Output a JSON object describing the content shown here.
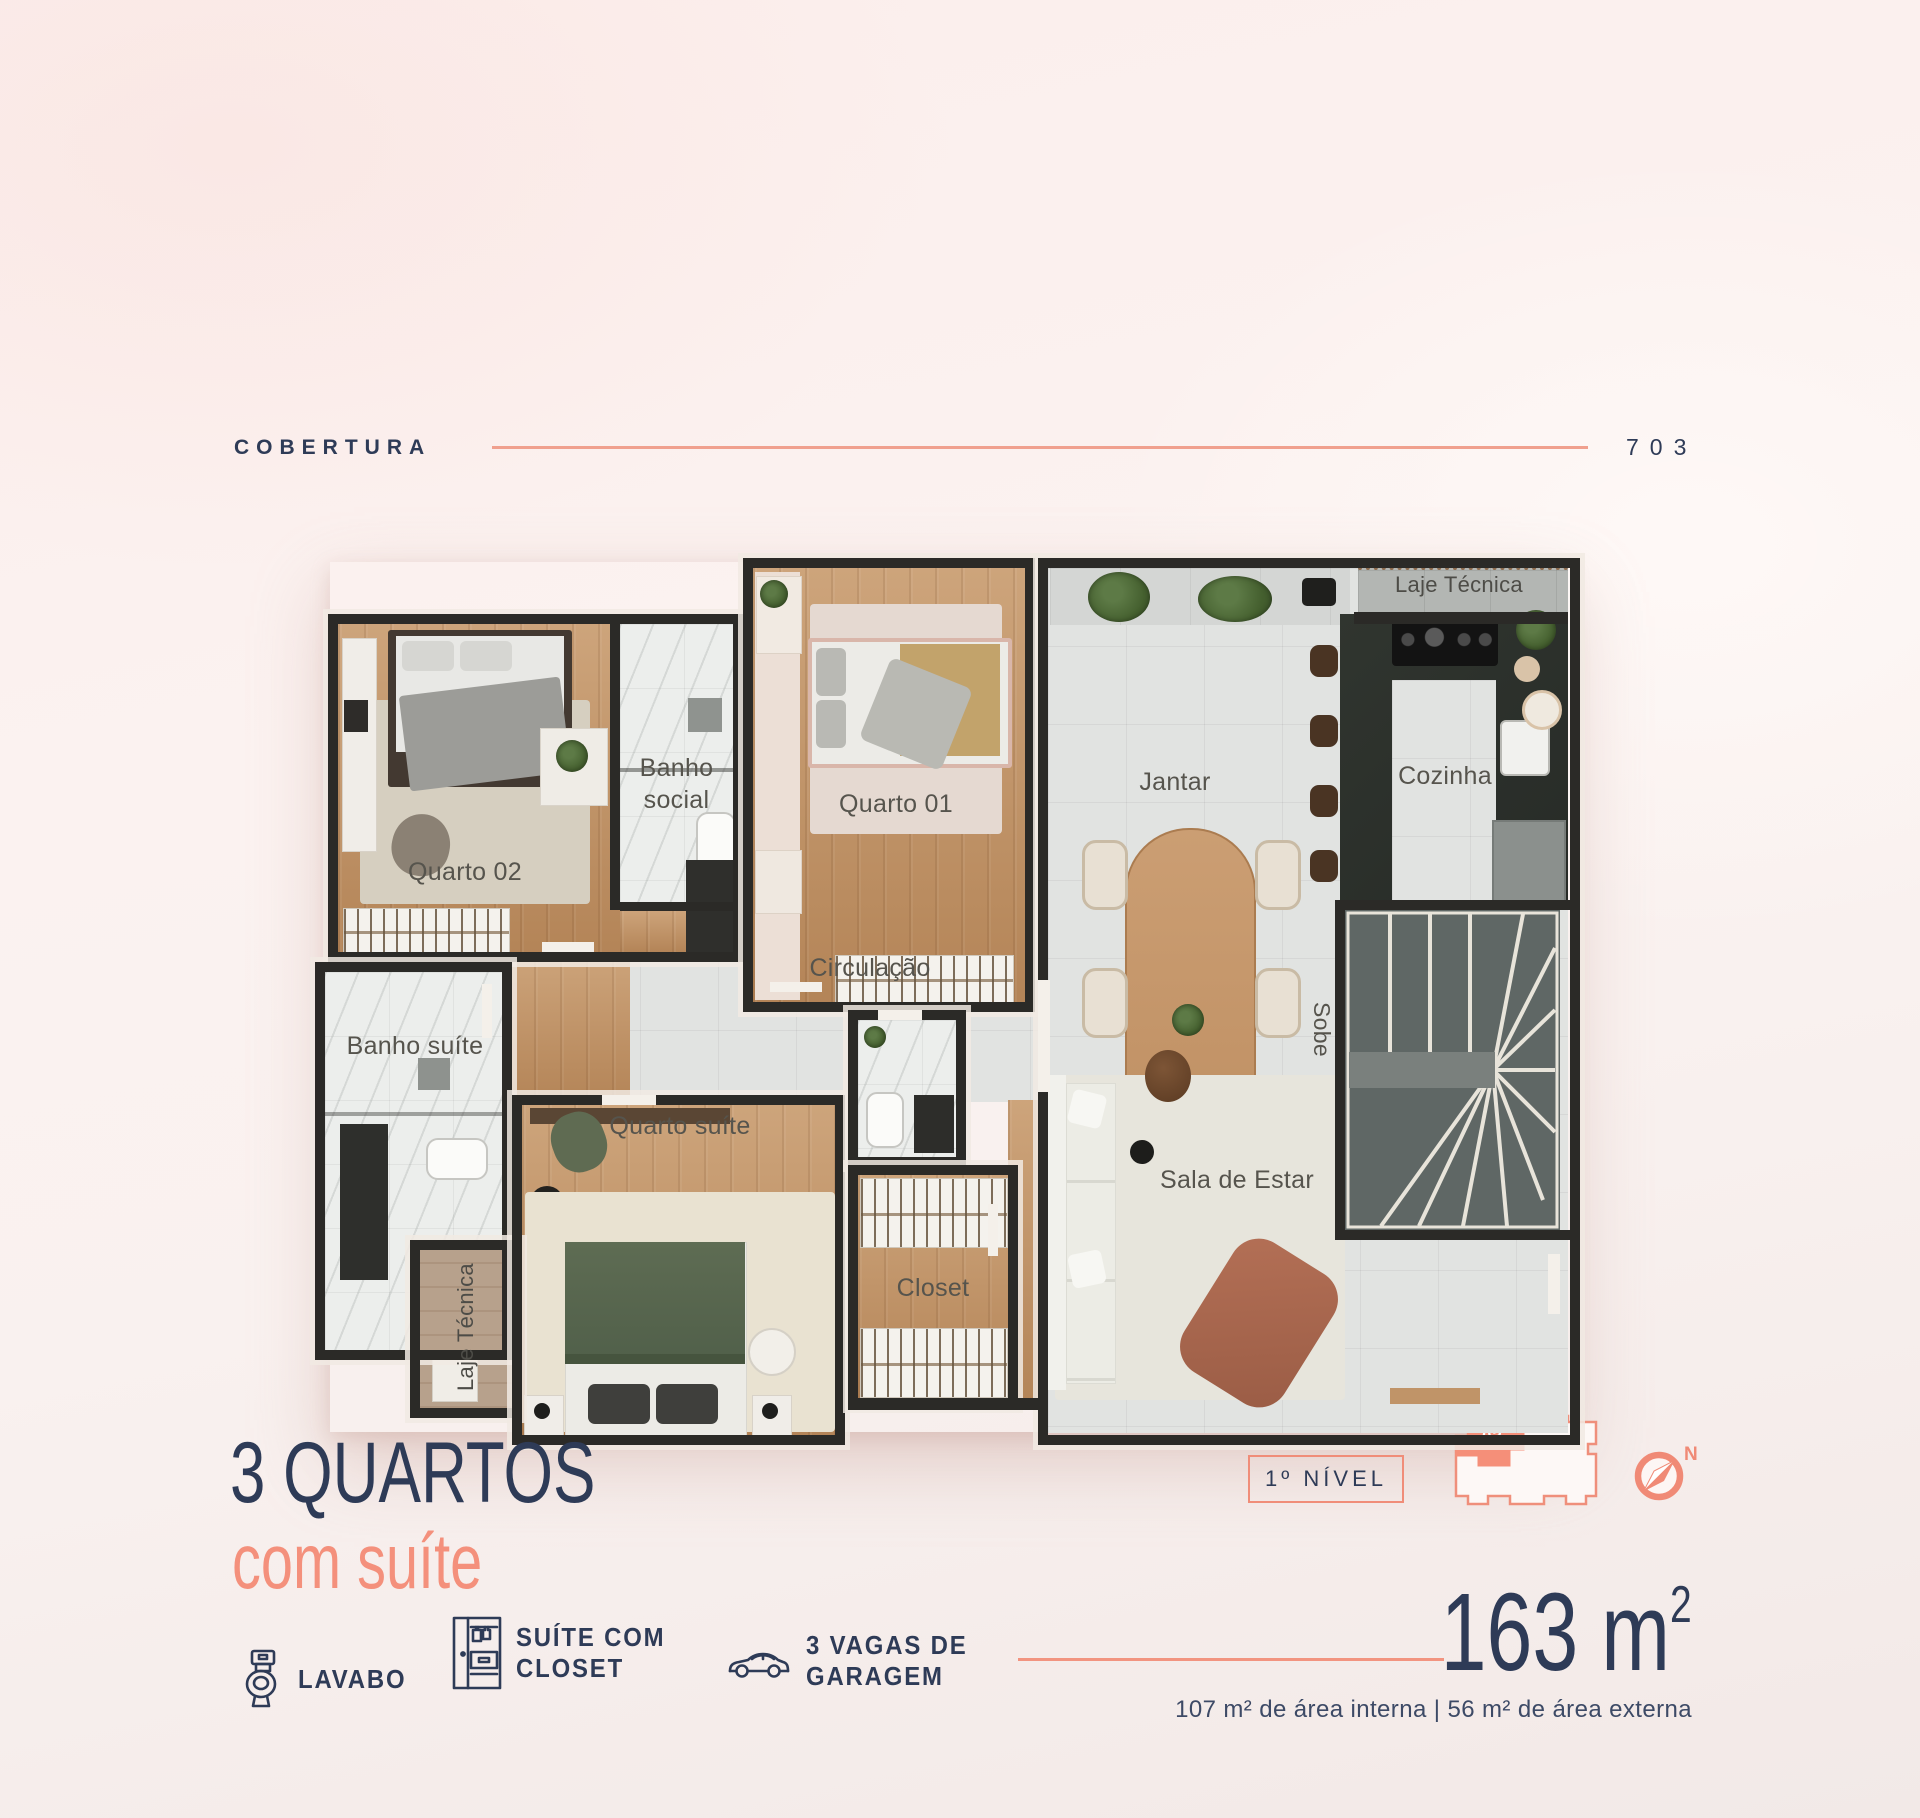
{
  "header": {
    "section_label": "COBERTURA",
    "unit_number": "703"
  },
  "floor_plan": {
    "rooms": {
      "jantar": "Jantar",
      "laje_tecnica_top": "Laje Técnica",
      "cozinha": "Cozinha",
      "quarto_01": "Quarto 01",
      "banho_social_line1": "Banho",
      "banho_social_line2": "social",
      "quarto_02": "Quarto 02",
      "circulacao": "Circulação",
      "banho_suite": "Banho suíte",
      "quarto_suite": "Quarto suíte",
      "closet": "Closet",
      "sala_de_estar": "Sala de Estar",
      "sobe": "Sobe",
      "laje_tecnica_bottom": "Laje Técnica"
    }
  },
  "summary": {
    "title": "3 QUARTOS",
    "subtitle": "com suíte",
    "features": [
      {
        "icon": "toilet-icon",
        "line1": "LAVABO",
        "line2": ""
      },
      {
        "icon": "wardrobe-icon",
        "line1": "SUÍTE COM",
        "line2": "CLOSET"
      },
      {
        "icon": "car-icon",
        "line1": "3 VAGAS DE",
        "line2": "GARAGEM"
      }
    ],
    "level_badge": "1º NÍVEL",
    "unit_marker": "03",
    "compass_north": "N",
    "area_value": "163 m",
    "area_superscript": "2",
    "area_details": "107 m² de área interna | 56 m² de área externa"
  },
  "colors": {
    "navy": "#2e3b57",
    "coral": "#f29180",
    "wall": "#2b2a27"
  }
}
